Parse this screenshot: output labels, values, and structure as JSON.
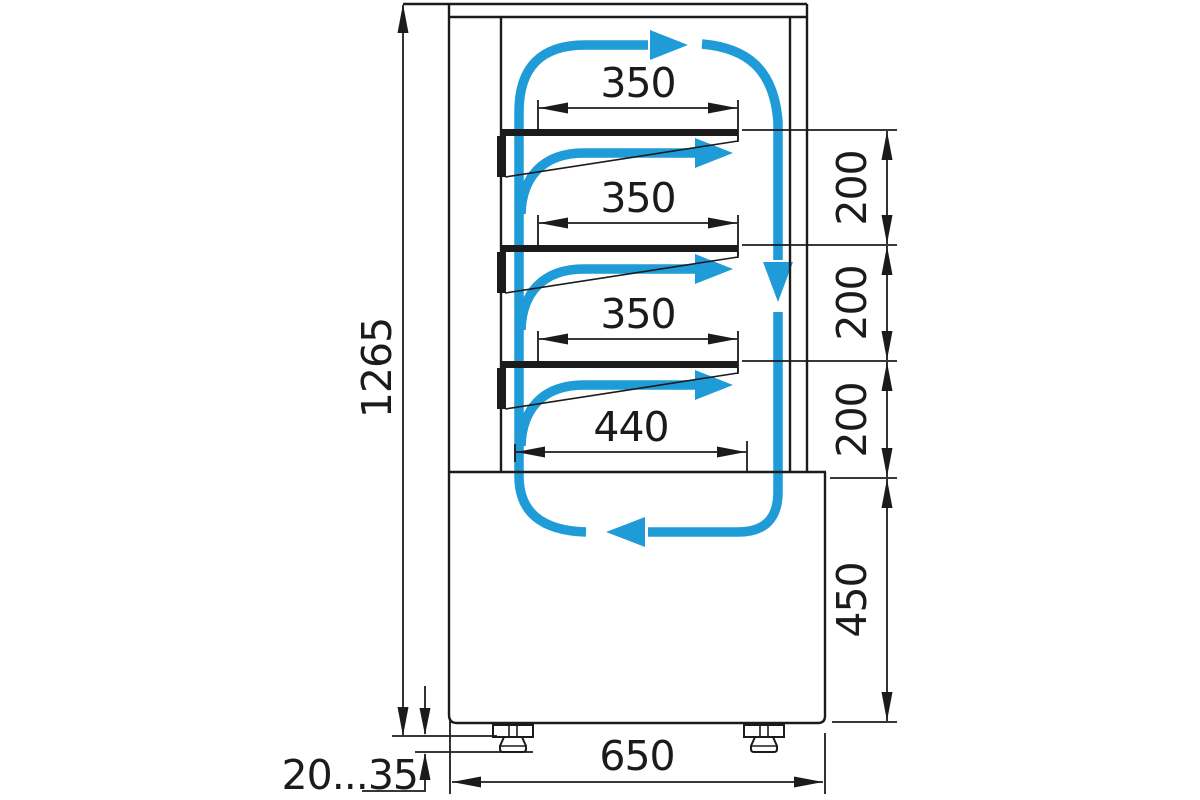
{
  "drawing": {
    "dimensions": {
      "overall_height": "1265",
      "shelf_depth_1": "350",
      "shelf_depth_2": "350",
      "shelf_depth_3": "350",
      "bottom_shelf_depth": "440",
      "shelf_gap_1": "200",
      "shelf_gap_2": "200",
      "shelf_gap_3": "200",
      "base_height": "450",
      "base_depth": "650",
      "feet_adjust_range": "20...35"
    },
    "colors": {
      "airflow_arrow": "#1F9BD7",
      "line": "#1B1B1B",
      "background": "#FFFFFF"
    }
  }
}
